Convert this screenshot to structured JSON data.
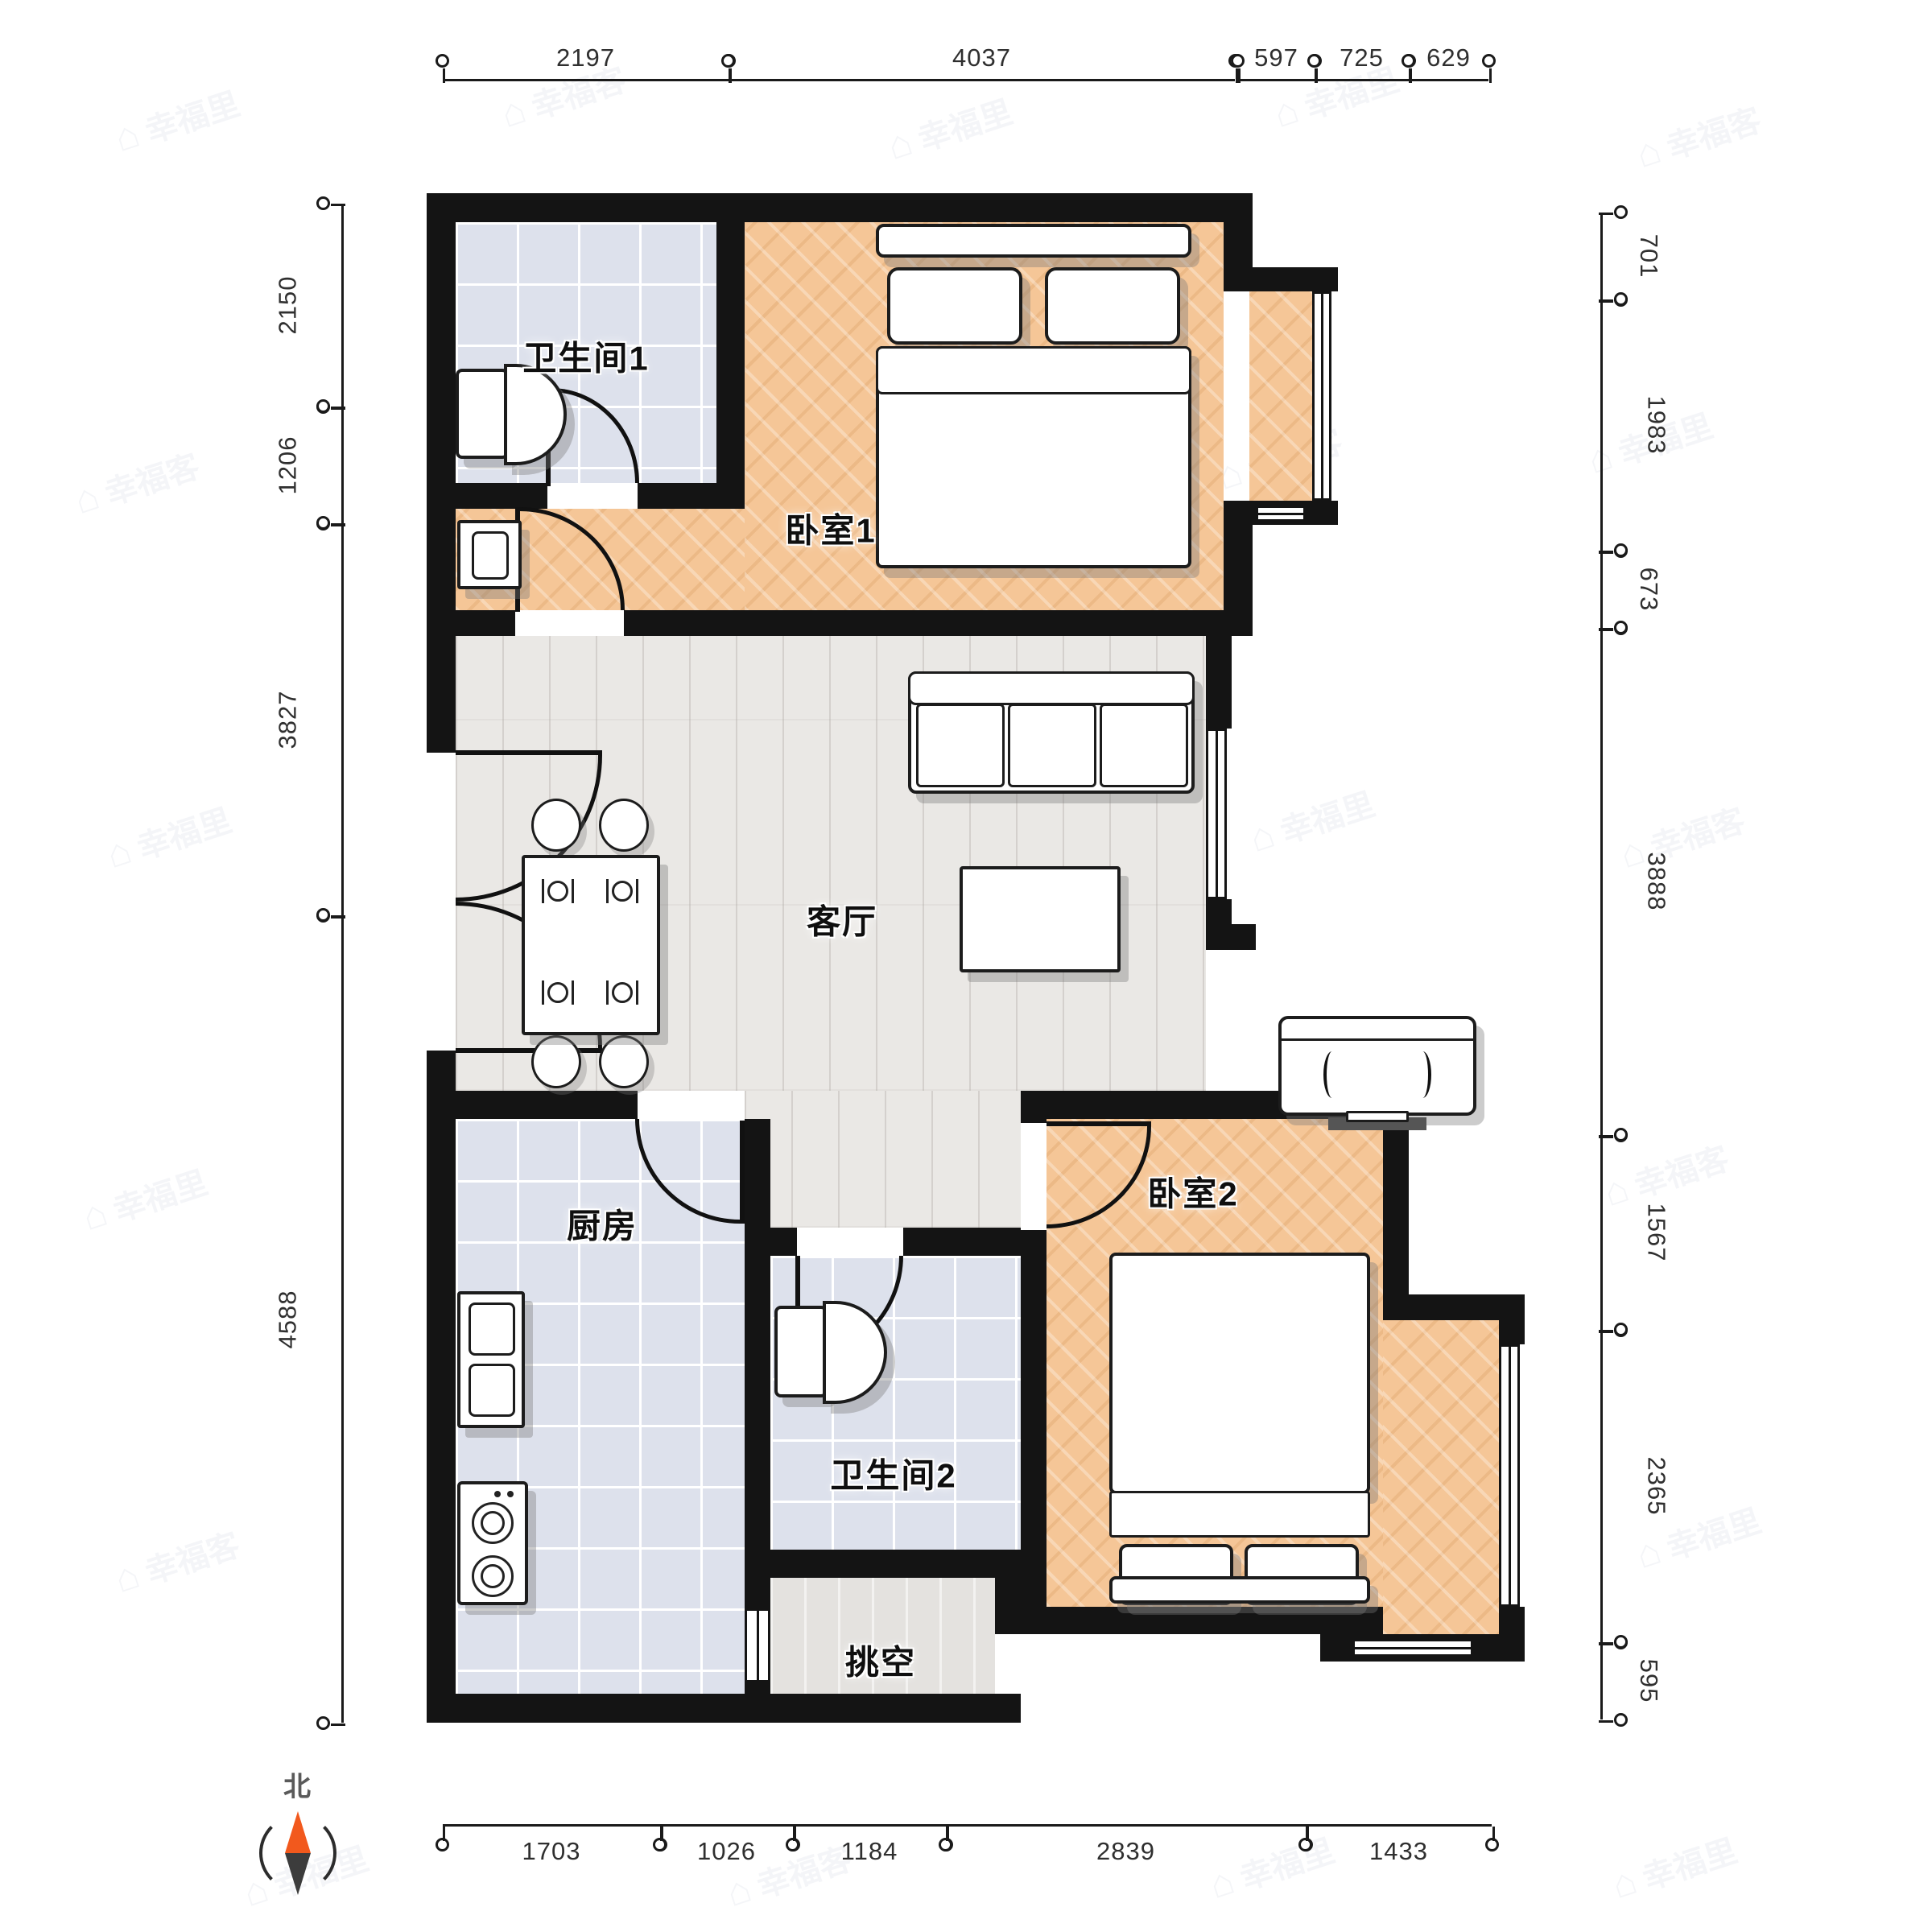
{
  "compass": {
    "label": "北"
  },
  "watermark": {
    "glyph": "⌂",
    "primary": "幸福里",
    "secondary": "幸福客"
  },
  "rooms": [
    {
      "id": "bathroom-1",
      "label": "卫生间1"
    },
    {
      "id": "bedroom-1",
      "label": "卧室1"
    },
    {
      "id": "living-room",
      "label": "客厅"
    },
    {
      "id": "kitchen",
      "label": "厨房"
    },
    {
      "id": "bathroom-2",
      "label": "卫生间2"
    },
    {
      "id": "void",
      "label": "挑空"
    },
    {
      "id": "bedroom-2",
      "label": "卧室2"
    }
  ],
  "dimensions": {
    "top": [
      "2197",
      "4037",
      "597",
      "725",
      "629"
    ],
    "left": [
      "2150",
      "1206",
      "3827",
      "4588"
    ],
    "right": [
      "701",
      "1983",
      "673",
      "3888",
      "1567",
      "2365",
      "595"
    ],
    "bottom": [
      "1703",
      "1026",
      "1184",
      "2839",
      "1433"
    ]
  },
  "colors": {
    "wall": "#141414",
    "wood_floor": "#f5c697",
    "tile_floor": "#dde1ec",
    "plank_floor": "#eae8e5",
    "compass_north": "#f2591d"
  },
  "furniture_icons": [
    "double-bed",
    "sofa",
    "coffee-table",
    "dining-table",
    "dining-chair",
    "tv",
    "toilet",
    "washbasin",
    "kitchen-sink",
    "stove"
  ]
}
